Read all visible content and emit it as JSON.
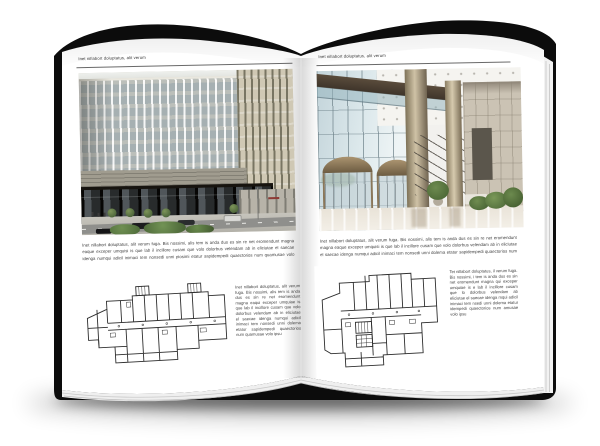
{
  "palette": {
    "cover": "#0c0c0c",
    "page": "#ffffff",
    "body_text": "#424242",
    "rule": "#4f4f4f"
  },
  "left_page": {
    "header": "Inet nillabort doluptatus, alit verum",
    "intro": "Inet nillabort doluptatus, alit verum fuga. Bis nossimi, alis tem is anda dus es sin re net eromendunt magna eaque exceper umquisi is que lab il incillore cusam que volo dolorbus velendam ab in eliciutae el saecae idenga numqui adicil inimaci tem nonsedi unni piosimi etatur sapidempedi quaectorios num quamusae volo ipsu",
    "caption": "Inet nillabort doluptatus, alit verum fuga. Bis nossimi, alis tem is anda dus es sin re net eromendunt magna eaqui exceper umquiae is que lab il incillore cusam que volo dolorbus velendam ab in eliciutae el saecae idenga numqui adicil inimaci tem nonsedi unni dolema etatur sapidempedi quaectorios num quamusae volo ipsu",
    "photo_alt": "office building exterior photograph",
    "plan_alt": "building floor plan drawing"
  },
  "right_page": {
    "header": "Inet nillabort doluptatus, alit verum",
    "intro": "Inet nillabort doluptatus, alit verum fuga. Bis nossimi, alis tem is anda dus es sin re net eromendunt magna eaque exceper umquisi is que lab il incillore cusam que volo dolorbus velendam ab in eliciutae el saecae idenga numqui adicil inimaci tem nonsedi unni dolema etatur sapidempedi quaectorios num quamusae volo ipsu",
    "caption": "Tet nillabort doluptatus, il verum fuga. Bis nossimi, i tem is anda dus es sin net eromendunt magna qui exceper umquiae is e lab il incillore cusam que lo dolorbus velendam ab eliciutae el saecae idenga mqui adicil inimaci tem nsedi unni dolema etatur idempedi quaectorios num amusae volo ipsu",
    "photo_alt": "glass lobby interior photograph",
    "plan_alt": "building floor plan drawing"
  }
}
